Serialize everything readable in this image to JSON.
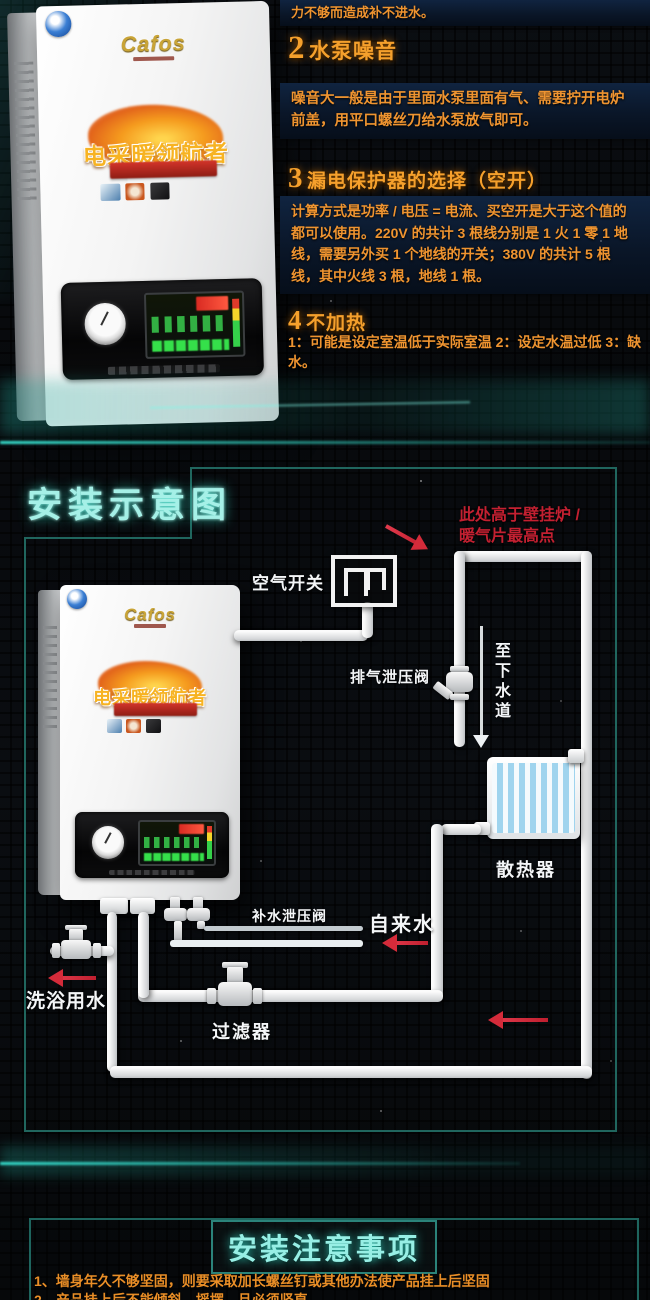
{
  "colors": {
    "accent_orange": "#ef9430",
    "accent_cyan": "#a5f0e7",
    "accent_teal_border": "#226b63",
    "accent_red": "#c9202e",
    "pipe_white": "#e9eef0",
    "navy_bar": "#0a1628"
  },
  "product": {
    "brand": "Cafos",
    "slogan": "电采暖领航者"
  },
  "faq": {
    "intro": "力不够而造成补不进水。",
    "items": [
      {
        "num": "2",
        "title": "水泵噪音",
        "body": "噪音大一般是由于里面水泵里面有气、需要拧开电炉前盖，用平口螺丝刀给水泵放气即可。"
      },
      {
        "num": "3",
        "title": "漏电保护器的选择（空开）",
        "body": "计算方式是功率 / 电压 = 电流、买空开是大于这个值的都可以使用。220V 的共计 3 根线分别是 1 火 1 零 1 地线，需要另外买 1 个地线的开关；380V 的共计 5 根线，其中火线 3 根，地线 1 根。"
      },
      {
        "num": "4",
        "title": "不加热",
        "body": "1：可能是设定室温低于实际室温 2：设定水温过低 3：缺水。"
      }
    ]
  },
  "diagram": {
    "title": "安装示意图",
    "labels": {
      "air_switch": "空气开关",
      "note_line1": "此处高于壁挂炉 /",
      "note_line2": "暖气片最高点",
      "exhaust_valve": "排气泄压阀",
      "to_sewer": "至下水道",
      "radiator": "散热器",
      "makeup_valve": "补水泄压阀",
      "tap_water": "自来水",
      "shower_water": "洗浴用水",
      "filter": "过滤器"
    }
  },
  "notes": {
    "title": "安装注意事项",
    "items": [
      "1、墙身年久不够坚固，则要采取加长螺丝钉或其他办法使产品挂上后坚固",
      "2、产品挂上后不能倾斜，摇摆，且必须竖直"
    ]
  }
}
